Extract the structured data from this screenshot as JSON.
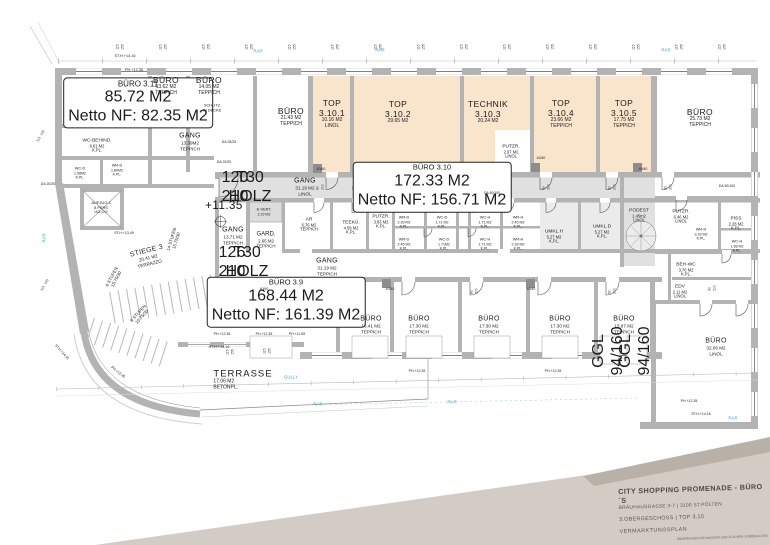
{
  "colors": {
    "peach": "#f9e4cc",
    "corridor_gray": "#e0e0e0",
    "wall_gray": "#b3b3b3",
    "accent_blue": "#3aa7c8",
    "titleblock_light": "#d3ccc4",
    "titleblock_dark": "#b9b1a8"
  },
  "rooms": {
    "buero_a": {
      "name": "BÜRO",
      "area": "9.67 M2",
      "finish": "TEPPICH"
    },
    "buero_311": {
      "name": "BÜRO 3.11",
      "area": "85.72 M2",
      "netto": "Netto NF: 82.35 M2"
    },
    "buero_b": {
      "name": "BÜRO",
      "area": "13.62 M2",
      "finish": "TEPPICH"
    },
    "buero_c": {
      "name": "BÜRO",
      "area": "14.05 M2",
      "finish": "TEPPICH"
    },
    "buero_d": {
      "name": "BÜRO",
      "area": "21.43 M2",
      "finish": "TEPPICH"
    },
    "top1": {
      "name": "TOP",
      "num": "3.10.1",
      "area": "10.16 M2",
      "finish": "LINOL"
    },
    "top2": {
      "name": "TOP",
      "num": "3.10.2",
      "area": "29.65 M2"
    },
    "technik": {
      "name": "TECHNIK",
      "num": "3.10.3",
      "area": "20.24 M2"
    },
    "putzr_a": {
      "name": "PUTZR.",
      "area": "2.97 M2",
      "finish": "LINOL"
    },
    "top4": {
      "name": "TOP",
      "num": "3.10.4",
      "area": "23.66 M2",
      "finish": "TEPPICH"
    },
    "top5": {
      "name": "TOP",
      "num": "3.10.5",
      "area": "17.75 M2",
      "finish": "TEPPICH"
    },
    "buero_e": {
      "name": "BÜRO",
      "area": "25.73 M2",
      "finish": "TEPPICH"
    },
    "gang_linol": {
      "name": "GANG",
      "area": "31.19 M2",
      "finish": "LINOL"
    },
    "buero_310": {
      "name": "BÜRO 3.10",
      "area": "172.33 M2",
      "netto": "Netto NF: 156.71 M2"
    },
    "gang_a": {
      "name": "GANG",
      "area": "13.39M2",
      "finish": "TEPPICH"
    },
    "wc_behind": {
      "name": "WC-BEHIND.",
      "area": "6.61 M2",
      "finish": "K.PL."
    },
    "wc_d1": {
      "name": "WC-D",
      "area": "1.58M2",
      "finish": "K.PL."
    },
    "wr_d1": {
      "name": "WR-D",
      "area": "1.80M2",
      "finish": "K.PL."
    },
    "aufzug": {
      "l1": "AUFZUG 4",
      "l2": "8 PERS",
      "l3": "UG-OG"
    },
    "gang_b": {
      "name": "GANG",
      "area": "13.71 M2",
      "finish": "TEPPICH"
    },
    "evert": {
      "name": "E-VERT.",
      "area": "2.29 M2"
    },
    "gard": {
      "name": "GARD.",
      "area": "2.65 M2",
      "finish": "TEPPICH"
    },
    "ar": {
      "name": "AR",
      "area": "6.76 M2",
      "finish": "TEPPICH"
    },
    "teekue": {
      "name": "TEEKÜ.",
      "area": "4.59 M2",
      "finish": "K.PL."
    },
    "putzr_b": {
      "name": "PUTZR.",
      "area": "3.83 M2",
      "finish": "K.PL."
    },
    "wr_d2": {
      "name": "WR-D",
      "area": "2.39 M2",
      "finish": "K.PL."
    },
    "wc_d2": {
      "name": "WC-D",
      "area": "1.71 M2",
      "finish": "K.PL."
    },
    "wr_d3": {
      "name": "WR-D",
      "area": "2.45 M2",
      "finish": "K.PL."
    },
    "wc_d3": {
      "name": "WC-D",
      "area": "1.71M2",
      "finish": "K.PL."
    },
    "wc_h1": {
      "name": "WC-H",
      "area": "1.71 M2",
      "finish": "K.PL."
    },
    "wr_h1": {
      "name": "WR-H",
      "area": "2.45 M2",
      "finish": "K.PL."
    },
    "wc_h2": {
      "name": "WC-H",
      "area": "1.71 M2",
      "finish": "K.PL."
    },
    "wr_h2": {
      "name": "WR-H",
      "area": "2.39 M2",
      "finish": "K.PL."
    },
    "umkl_h": {
      "name": "UMKL.H",
      "area": "5.27 M2",
      "finish": "K.PL."
    },
    "umkl_d": {
      "name": "UMKL.D",
      "area": "5.27 M2",
      "finish": "K.PL."
    },
    "podest": {
      "name": "PODEST",
      "area": "1.45m2",
      "finish": "LINOL"
    },
    "putzr_c": {
      "name": "PUTZR.",
      "area": "6.46 M2",
      "finish": "LINOL"
    },
    "wr_h3": {
      "name": "WR-H",
      "area": "3.33 M2",
      "finish": "K.PL."
    },
    "piss": {
      "name": "PISS",
      "area": "2.28 M2",
      "finish": "K.PL."
    },
    "wc_h3": {
      "name": "WC-H",
      "area": "1.58 M2",
      "finish": "K.PL."
    },
    "beh_wc": {
      "name": "BEH-WC",
      "area": "3.76 M2",
      "finish": "K.PL."
    },
    "edv": {
      "name": "EDV",
      "area": "2.11 M2",
      "finish": "LINOL"
    },
    "buero_32": {
      "name": "BÜRO",
      "area": "32.06 M2",
      "finish": "LINOL"
    },
    "buero_f": {
      "name": "BÜRO",
      "area": "19.83 M2",
      "finish": "TEPPICH"
    },
    "buero_39": {
      "name": "BÜRO 3.9",
      "area": "168.44 M2",
      "netto": "Netto NF: 161.39 M2"
    },
    "gang_teppich": {
      "name": "GANG",
      "area": "31.19 M2",
      "finish": "TEPPICH"
    },
    "buero_g": {
      "name": "BÜRO",
      "area": "16.41 M2",
      "finish": "TEPPICH"
    },
    "buero_h": {
      "name": "BÜRO",
      "area": "17.30 M2",
      "finish": "TEPPICH"
    },
    "buero_i": {
      "name": "BÜRO",
      "area": "17.30 M2",
      "finish": "TEPPICH"
    },
    "buero_j": {
      "name": "BÜRO",
      "area": "17.30 M2",
      "finish": "TEPPICH"
    },
    "buero_k": {
      "name": "BÜRO",
      "area": "15.97 M2",
      "finish": "TEPPICH"
    },
    "stiege": {
      "name": "STIEGE 3",
      "area": "20.41 M2",
      "finish": "TERRAZZO"
    },
    "terrasse": {
      "name": "TERRASSE",
      "area": "17.06 M2",
      "finish": "BETONPL."
    }
  },
  "annotations": {
    "level": "+11.35",
    "schlitz1": "SCHLITZ",
    "schlitz2": "IN DECKE",
    "da2525": "DA 25/25",
    "da2020": "DA 20/20",
    "da60100": "DA 60/100",
    "da90100": "DA 90/100",
    "p4040": "40/40",
    "sth1416": "ST.H.+14.16",
    "sth1401": "ST.H.+14.01",
    "sth1349": "ST.H.+13.49",
    "ph1235": "PH.+12.35",
    "ph1165": "PH.+11.65",
    "t30": "T30",
    "holz": "HOLZ",
    "d120": "120",
    "d210": "210",
    "d126": "126",
    "stufen14": "14 STUFEN",
    "stufen6": "6 STUFEN",
    "steig": "15.75/30",
    "ggl": "GGL",
    "ggl_size": "94/160",
    "rar": "RAR",
    "gully": "GULLY"
  },
  "dims": {
    "d115": "115",
    "d155": "155",
    "d80": "80",
    "d90": "90",
    "d200": "200"
  },
  "title_block": {
    "project": "CITY SHOPPING PROMENADE - BÜRO´S",
    "address": "BRÄUHAUSGASSE 3-7 | 3100 ST.PÖLTEN",
    "floor": "3.OBERGESCHOSS | TOP 3.10",
    "plan_type": "VERMARKTUNGSPLAN",
    "note": "ÄNDERUNGEN BEI MASSEN UND FLÄCHEN VORBEHALTEN"
  }
}
